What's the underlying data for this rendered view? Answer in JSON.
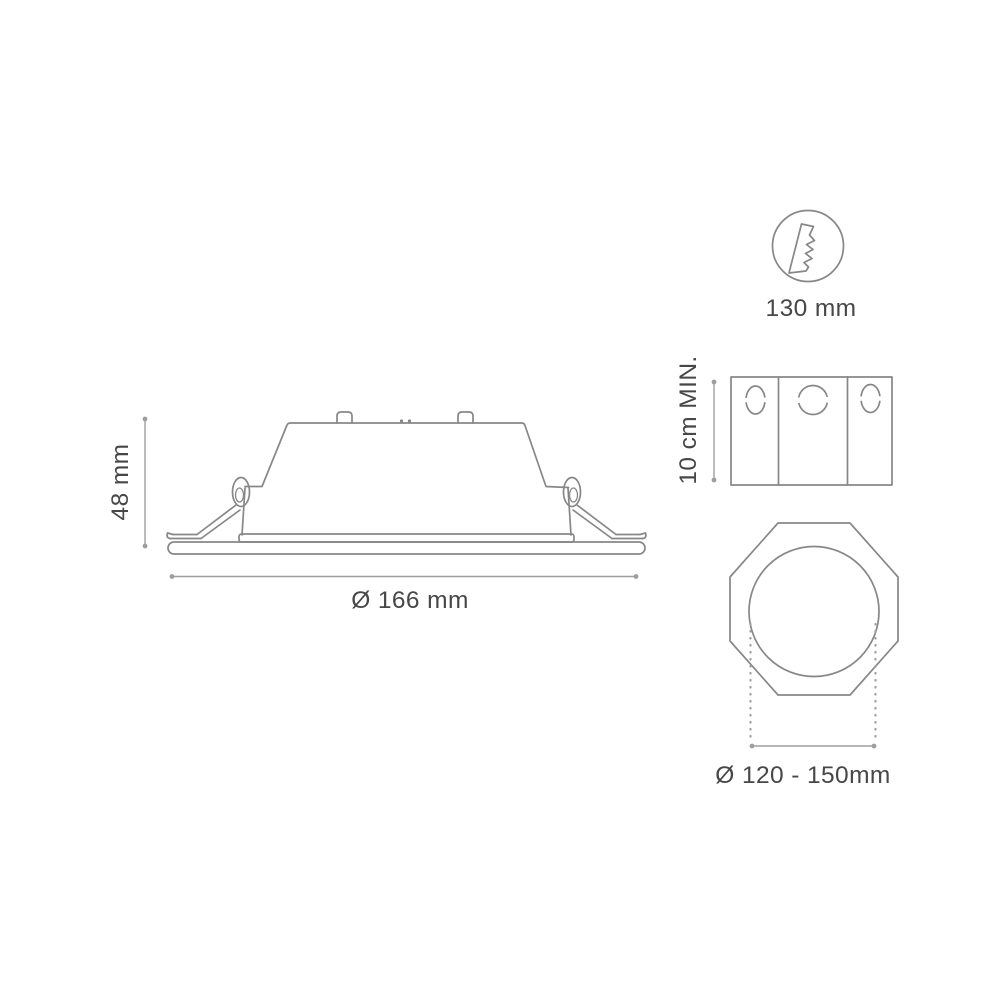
{
  "theme": {
    "bg_color": "#ffffff",
    "line_color": "#878787",
    "dim_color": "#9e9e9e",
    "text_color": "#474747"
  },
  "figures": {
    "side_view": {
      "description": "recessed downlight side elevation with spring clips and trim ring",
      "height_label": "48 mm",
      "diameter_label": "Ø 166 mm"
    },
    "cutout_tool": {
      "icon": "hole-saw-icon",
      "label": "130 mm"
    },
    "recess_box": {
      "description": "mounting box top view with knockout holes",
      "depth_label": "10 cm MIN."
    },
    "ceiling_cutout": {
      "description": "octagonal ceiling opening with circular cutout",
      "diameter_label": "Ø 120 - 150mm"
    }
  }
}
